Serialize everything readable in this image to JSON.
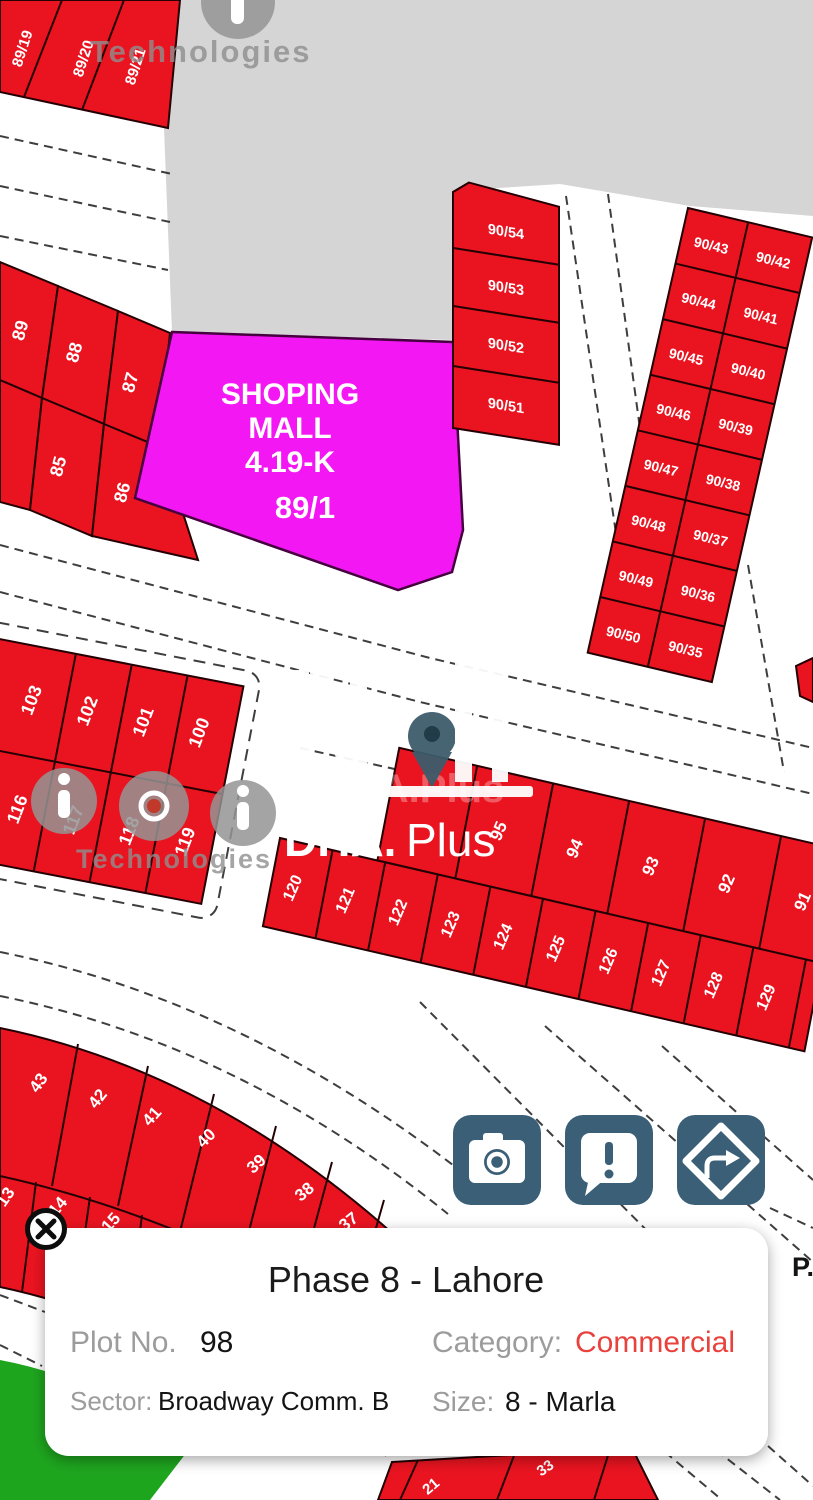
{
  "app": {
    "road_label": "P."
  },
  "colors": {
    "plot_red": "#ea1420",
    "mall_magenta": "#f318f3",
    "button_blue": "#3a5f77",
    "category_red": "#e8423d",
    "green_area": "#1ea51e",
    "gray_block": "#d5d5d5"
  },
  "icons": {
    "camera": "camera-icon",
    "report": "report-bubble-icon",
    "directions": "directions-diamond-icon",
    "close": "close-circle-icon",
    "info": "info-circle-icon"
  },
  "watermarks": {
    "iqi_text_top": "Technologies",
    "iqi_text_mid": "Technologies",
    "dha_ghost": "DHA.Plus",
    "dha_bold": "DHA.",
    "dha_light": "Plus"
  },
  "mall": {
    "name_line1": "SHOPING",
    "name_line2": "MALL",
    "size": "4.19-K",
    "plot": "89/1"
  },
  "plots": {
    "strip_top": [
      "89/19",
      "89/20",
      "89/21"
    ],
    "strip_left_row1": [
      "89",
      "88",
      "87"
    ],
    "strip_left_row2": [
      "85",
      "86"
    ],
    "column_90_50s": [
      "90/54",
      "90/53",
      "90/52",
      "90/51"
    ],
    "column_90_40s": [
      "90/43",
      "90/44",
      "90/45",
      "90/46",
      "90/47",
      "90/48",
      "90/49",
      "90/50"
    ],
    "column_90_30s": [
      "90/42",
      "90/41",
      "90/40",
      "90/39",
      "90/38",
      "90/37",
      "90/36",
      "90/35"
    ],
    "block_100s_row1": [
      "103",
      "102",
      "101",
      "100"
    ],
    "block_100s_row2": [
      "116",
      "117",
      "118",
      "119"
    ],
    "block_90s": [
      "95",
      "94",
      "93",
      "92",
      "91"
    ],
    "block_120s": [
      "120",
      "121",
      "122",
      "123",
      "124",
      "125",
      "126",
      "127",
      "128",
      "129"
    ],
    "arc_row1": [
      "43",
      "42",
      "41",
      "40",
      "39",
      "38",
      "37"
    ],
    "arc_row2": [
      "13",
      "14",
      "15"
    ],
    "bottom_row": [
      "21",
      "33"
    ]
  },
  "info_card": {
    "title": "Phase 8 - Lahore",
    "plot_label": "Plot No. ",
    "plot_value": "98",
    "category_label": "Category: ",
    "category_value": "Commercial",
    "sector_label": "Sector: ",
    "sector_value": "Broadway Comm. B",
    "size_label": "Size: ",
    "size_value": "8 - Marla"
  }
}
